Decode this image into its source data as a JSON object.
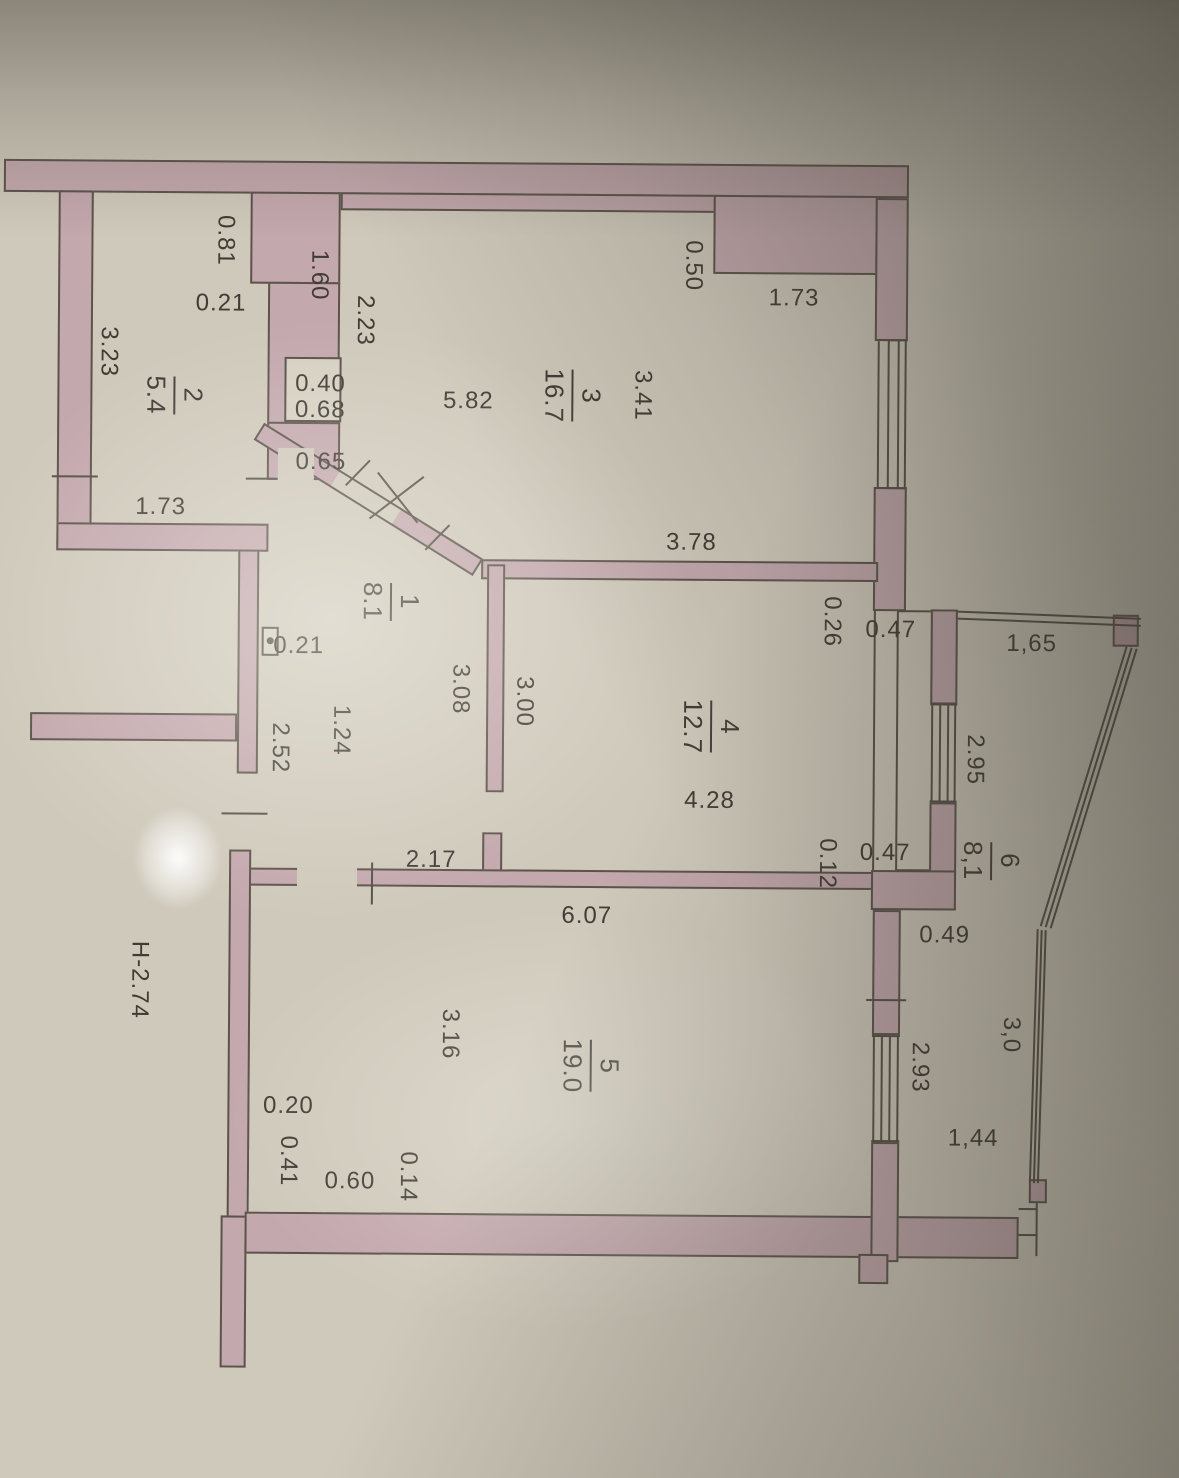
{
  "document": {
    "kind": "apartment floor plan (photographed technical drawing)",
    "height_label": "Н-2.74"
  },
  "colors": {
    "paper": "#cfc9bb",
    "wall_fill": "#c3a8ad",
    "line": "#554f46",
    "text": "#403c35"
  },
  "rooms": [
    {
      "number": "1",
      "area": "8.1"
    },
    {
      "number": "2",
      "area": "5.4"
    },
    {
      "number": "3",
      "area": "16.7"
    },
    {
      "number": "4",
      "area": "12.7"
    },
    {
      "number": "5",
      "area": "19.0"
    },
    {
      "number": "6",
      "area": "8,1"
    }
  ],
  "dims": {
    "d_050": "0.50",
    "d_173_top": "1.73",
    "d_341": "3.41",
    "d_223": "2.23",
    "d_160": "1.60",
    "d_081": "0.81",
    "d_021_room2": "0.21",
    "d_323": "3.23",
    "d_040": "0.40",
    "d_068": "0.68",
    "d_582": "5.82",
    "d_065": "0.65",
    "d_173_room2": "1.73",
    "d_378": "3.78",
    "d_026": "0.26",
    "d_047_top": "0.47",
    "d_165": "1,65",
    "d_021_room1": "0.21",
    "d_295": "2.95",
    "d_308": "3.08",
    "d_300": "3.00",
    "d_124": "1.24",
    "d_252": "2.52",
    "d_428": "4.28",
    "d_012": "0.12",
    "d_047_bottom": "0.47",
    "d_217": "2.17",
    "d_607": "6.07",
    "d_049": "0.49",
    "d_30": "3,0",
    "d_293": "2.93",
    "d_144": "1,44",
    "d_316": "3.16",
    "d_020": "0.20",
    "d_041": "0.41",
    "d_060": "0.60",
    "d_014": "0.14",
    "height": "Н-2.74"
  }
}
